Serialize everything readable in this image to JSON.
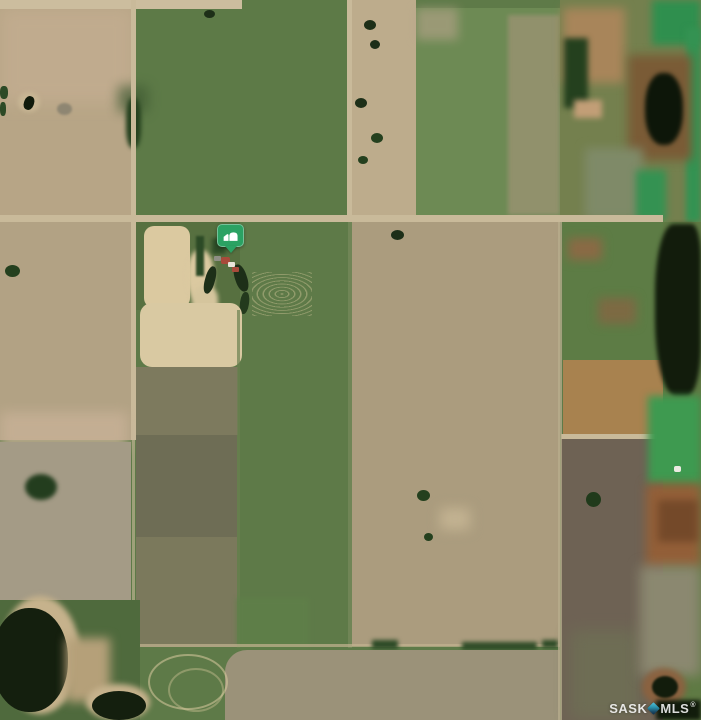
{
  "view": {
    "type": "satellite-aerial-map",
    "width_px": 701,
    "height_px": 720
  },
  "marker": {
    "label": "property-location",
    "x": 217,
    "y": 224,
    "badge_color": "#2BA263",
    "glyph": "farm-barn-icon",
    "glyph_color": "#FFFFFF"
  },
  "watermark": {
    "prefix": "SASK",
    "suffix": "MLS",
    "registered": "®",
    "text_color": "rgba(255,255,255,0.85)",
    "diamond_color_top": "#54C4DC",
    "diamond_color_bottom": "#0F2B46"
  },
  "palette": {
    "cropland_tan": "#B2A284",
    "pasture_green": "#5E7A48",
    "stubble_gray": "#A49B86",
    "seeded_green_rows": "#6D8A54",
    "olive_pasture": "#7B795C",
    "dark_brown_field": "#6E6254",
    "orange_field": "#A8824F",
    "wetland_emerald": "#3E9A50",
    "pond_dark": "#121C0C",
    "road_tan": "#C9BA9A",
    "farmyard_tan": "#DBC9A0",
    "rust_marsh": "#935F38"
  },
  "map": {
    "regions": [
      {
        "name": "pasture-base",
        "x": 0,
        "y": 0,
        "w": 701,
        "h": 720,
        "color": "#5e7a48",
        "cls": "mottle"
      },
      {
        "name": "field-topleft-tan",
        "x": 0,
        "y": 0,
        "w": 133,
        "h": 222,
        "color": "#b7a586",
        "cls": "rows-h"
      },
      {
        "name": "field-topleft-pink-wash",
        "x": 0,
        "y": 8,
        "w": 133,
        "h": 95,
        "color": "#c9b195",
        "blur": 8,
        "op": 0.55
      },
      {
        "name": "field-topmid-green",
        "x": 136,
        "y": 0,
        "w": 211,
        "h": 218,
        "color": "#5d7a47",
        "cls": "mottle"
      },
      {
        "name": "field-topright-tan-strip",
        "x": 352,
        "y": 0,
        "w": 64,
        "h": 218,
        "color": "#bdac8c",
        "cls": "rows-h"
      },
      {
        "name": "field-topright-green-striped",
        "x": 416,
        "y": 8,
        "w": 144,
        "h": 210,
        "color": "#6d8a54",
        "cls": "rows-v"
      },
      {
        "name": "field-striped-tan-east-half",
        "x": 508,
        "y": 15,
        "w": 52,
        "h": 200,
        "color": "#9a9372",
        "cls": "rows-v",
        "op": 0.8,
        "blur": 2
      },
      {
        "name": "field-striped-pink-corner",
        "x": 416,
        "y": 8,
        "w": 42,
        "h": 32,
        "color": "#b9a48c",
        "blur": 5,
        "op": 0.6
      },
      {
        "name": "road-top-strip",
        "x": 0,
        "y": 0,
        "w": 242,
        "h": 9,
        "color": "#ccbd9e"
      },
      {
        "name": "wetland-topright-base",
        "x": 560,
        "y": 0,
        "w": 141,
        "h": 222,
        "color": "#74804e",
        "cls": "mottle"
      },
      {
        "name": "wetland-brown-patch",
        "x": 563,
        "y": 8,
        "w": 62,
        "h": 75,
        "color": "#a8855a",
        "blur": 5
      },
      {
        "name": "wetland-dark-trees",
        "x": 564,
        "y": 38,
        "w": 24,
        "h": 70,
        "color": "#24401e",
        "blur": 3
      },
      {
        "name": "wetland-emerald-top",
        "x": 652,
        "y": 0,
        "w": 49,
        "h": 45,
        "color": "#2f8f4e",
        "blur": 4
      },
      {
        "name": "wetland-emerald-right-band",
        "x": 686,
        "y": 28,
        "w": 15,
        "h": 194,
        "color": "#349252",
        "blur": 3
      },
      {
        "name": "wetland-pond-surround",
        "x": 628,
        "y": 55,
        "w": 64,
        "h": 105,
        "color": "#7a5b36",
        "blur": 5
      },
      {
        "name": "wetland-pond-dark",
        "x": 645,
        "y": 73,
        "w": 38,
        "h": 72,
        "color": "#0d1609",
        "r": "45%",
        "blur": 2
      },
      {
        "name": "wetland-marsh-gray",
        "x": 585,
        "y": 148,
        "w": 58,
        "h": 72,
        "color": "#7f8a68",
        "blur": 5
      },
      {
        "name": "wetland-emerald-low",
        "x": 636,
        "y": 170,
        "w": 30,
        "h": 50,
        "color": "#349252",
        "blur": 4
      },
      {
        "name": "wetland-pink-spot",
        "x": 574,
        "y": 100,
        "w": 28,
        "h": 18,
        "color": "#c29e77",
        "blur": 3
      },
      {
        "name": "pond-dot-topmid",
        "x": 204,
        "y": 10,
        "w": 11,
        "h": 8,
        "color": "#1d2f18",
        "r": "50%"
      },
      {
        "name": "dark-smudge-topmid",
        "x": 118,
        "y": 86,
        "w": 30,
        "h": 26,
        "color": "#3f5a33",
        "blur": 6,
        "op": 0.7
      },
      {
        "name": "tree-clump-road-west",
        "x": 126,
        "y": 98,
        "w": 15,
        "h": 50,
        "color": "#24401e",
        "blur": 2,
        "r": "40%"
      },
      {
        "name": "slough-topleft-ring",
        "x": 18,
        "y": 92,
        "w": 22,
        "h": 20,
        "color": "#c8b694",
        "r": "50%",
        "blur": 2
      },
      {
        "name": "slough-topleft-dark",
        "x": 24,
        "y": 96,
        "w": 10,
        "h": 14,
        "color": "#101a0b",
        "r": "45%",
        "rot": 20
      },
      {
        "name": "green-dot-left-edge-1",
        "x": 0,
        "y": 86,
        "w": 8,
        "h": 13,
        "color": "#2c4a26",
        "r": "40%"
      },
      {
        "name": "green-dot-left-edge-2",
        "x": 0,
        "y": 102,
        "w": 6,
        "h": 14,
        "color": "#2c4a26",
        "r": "40%"
      },
      {
        "name": "gray-blob-topleft",
        "x": 57,
        "y": 103,
        "w": 15,
        "h": 12,
        "color": "#8e8672",
        "r": "50%",
        "blur": 1
      },
      {
        "name": "tree-dot-strip-1",
        "x": 364,
        "y": 20,
        "w": 12,
        "h": 10,
        "color": "#1d2f18",
        "r": "50%"
      },
      {
        "name": "tree-dot-strip-2",
        "x": 370,
        "y": 40,
        "w": 10,
        "h": 9,
        "color": "#1d2f18",
        "r": "50%"
      },
      {
        "name": "tree-dot-strip-3",
        "x": 355,
        "y": 98,
        "w": 12,
        "h": 10,
        "color": "#1d2f18",
        "r": "50%"
      },
      {
        "name": "tree-dot-strip-4",
        "x": 371,
        "y": 133,
        "w": 12,
        "h": 10,
        "color": "#24401e",
        "r": "50%"
      },
      {
        "name": "tree-dot-strip-5",
        "x": 358,
        "y": 156,
        "w": 10,
        "h": 8,
        "color": "#24401e",
        "r": "50%"
      },
      {
        "name": "road-horizontal",
        "x": 0,
        "y": 215,
        "w": 663,
        "h": 7,
        "color": "#c9ba9a"
      },
      {
        "name": "road-vertical-west",
        "x": 131,
        "y": 0,
        "w": 5,
        "h": 440,
        "color": "#c9ba9a"
      },
      {
        "name": "road-vertical-mid",
        "x": 347,
        "y": 0,
        "w": 5,
        "h": 221,
        "color": "#c9ba9a"
      },
      {
        "name": "field-left-tan-lower",
        "x": 0,
        "y": 222,
        "w": 131,
        "h": 218,
        "color": "#b2a284",
        "cls": "rows-h"
      },
      {
        "name": "trees-left-lower",
        "x": 5,
        "y": 265,
        "w": 15,
        "h": 12,
        "color": "#24401e",
        "r": "50%"
      },
      {
        "name": "field-left-pink-band",
        "x": 0,
        "y": 412,
        "w": 128,
        "h": 38,
        "color": "#c8b197",
        "blur": 6,
        "op": 0.8
      },
      {
        "name": "field-left-gray",
        "x": 0,
        "y": 442,
        "w": 131,
        "h": 188,
        "color": "#a49b86",
        "cls": "mottle"
      },
      {
        "name": "tree-gray-shadow",
        "x": 25,
        "y": 474,
        "w": 32,
        "h": 26,
        "color": "#233d1e",
        "r": "50%",
        "blur": 2
      },
      {
        "name": "boundary-vertical-west-lower",
        "x": 132,
        "y": 440,
        "w": 3,
        "h": 210,
        "color": "#cabb9b",
        "op": 0.6
      },
      {
        "name": "yard-green-backdrop",
        "x": 136,
        "y": 222,
        "w": 104,
        "h": 88,
        "color": "#566f3f",
        "op": 0.85
      },
      {
        "name": "yard-scribble-patch",
        "x": 144,
        "y": 226,
        "w": 46,
        "h": 82,
        "color": "#dbc9a0",
        "cls": "scribble",
        "r": "10px"
      },
      {
        "name": "yard-tan-blob-1",
        "x": 187,
        "y": 250,
        "w": 27,
        "h": 52,
        "color": "#dbc9a0",
        "r": "45%",
        "blur": 2
      },
      {
        "name": "yard-tan-blob-2",
        "x": 192,
        "y": 286,
        "w": 26,
        "h": 32,
        "color": "#d5c59d",
        "r": "40%",
        "blur": 2
      },
      {
        "name": "yard-shelterbelt",
        "x": 196,
        "y": 236,
        "w": 8,
        "h": 40,
        "color": "#2c4a26",
        "blur": 1
      },
      {
        "name": "yard-trees-2",
        "x": 212,
        "y": 238,
        "w": 14,
        "h": 16,
        "color": "#2c4a26",
        "blur": 2
      },
      {
        "name": "yard-dugout-1",
        "x": 205,
        "y": 266,
        "w": 10,
        "h": 28,
        "color": "#1d2f18",
        "r": "45%",
        "rot": 15
      },
      {
        "name": "yard-dugout-2",
        "x": 235,
        "y": 264,
        "w": 12,
        "h": 28,
        "color": "#1d2f18",
        "r": "45%",
        "rot": -18
      },
      {
        "name": "yard-dugout-3",
        "x": 240,
        "y": 292,
        "w": 9,
        "h": 22,
        "color": "#233a1d",
        "r": "45%",
        "rot": 8
      },
      {
        "name": "yard-building-gray",
        "x": 214,
        "y": 256,
        "w": 7,
        "h": 5,
        "color": "#8e8e84",
        "r": "1px"
      },
      {
        "name": "yard-building-red-1",
        "x": 221,
        "y": 257,
        "w": 9,
        "h": 7,
        "color": "#a84a3a",
        "r": "2px"
      },
      {
        "name": "yard-building-white",
        "x": 228,
        "y": 262,
        "w": 7,
        "h": 5,
        "color": "#e9e5da",
        "r": "1px"
      },
      {
        "name": "yard-building-red-2",
        "x": 232,
        "y": 267,
        "w": 7,
        "h": 5,
        "color": "#a84a3a",
        "r": "1px"
      },
      {
        "name": "yard-scratches-east",
        "x": 252,
        "y": 272,
        "w": 60,
        "h": 44,
        "cls": "scribble-faint"
      },
      {
        "name": "bale-yard-tan-patch",
        "x": 140,
        "y": 303,
        "w": 102,
        "h": 64,
        "color": "#d9c9a2",
        "cls": "scribble",
        "r": "12px"
      },
      {
        "name": "pasture-mid-brown-upper",
        "x": 136,
        "y": 367,
        "w": 102,
        "h": 68,
        "color": "#7d7a5e",
        "cls": "scribble-faint2"
      },
      {
        "name": "pasture-mid-dark",
        "x": 136,
        "y": 435,
        "w": 101,
        "h": 102,
        "color": "#6e6d55",
        "cls": "mottle"
      },
      {
        "name": "pasture-mid-olive",
        "x": 136,
        "y": 537,
        "w": 101,
        "h": 110,
        "color": "#7b795c",
        "cls": "mottle"
      },
      {
        "name": "boundary-east-of-olive",
        "x": 237,
        "y": 310,
        "w": 3,
        "h": 338,
        "color": "#6a8050",
        "op": 0.7
      },
      {
        "name": "green-strip-bright",
        "x": 237,
        "y": 598,
        "w": 72,
        "h": 50,
        "color": "#5f7f49",
        "blur": 3,
        "op": 0.9
      },
      {
        "name": "field-big-diagonal",
        "x": 352,
        "y": 222,
        "w": 208,
        "h": 424,
        "color": "#ab9c7e",
        "cls": "rows-d"
      },
      {
        "name": "boundary-vertical-mid-lower",
        "x": 348,
        "y": 222,
        "w": 4,
        "h": 426,
        "color": "#74885a",
        "op": 0.8
      },
      {
        "name": "field-diag-tree-1",
        "x": 391,
        "y": 230,
        "w": 13,
        "h": 10,
        "color": "#1d2f18",
        "r": "50%"
      },
      {
        "name": "field-diag-tree-2",
        "x": 417,
        "y": 490,
        "w": 13,
        "h": 11,
        "color": "#24401e",
        "r": "50%"
      },
      {
        "name": "field-diag-tree-3",
        "x": 424,
        "y": 533,
        "w": 9,
        "h": 8,
        "color": "#24401e",
        "r": "50%"
      },
      {
        "name": "field-diag-light-blob",
        "x": 440,
        "y": 508,
        "w": 30,
        "h": 22,
        "color": "#c2b291",
        "blur": 6
      },
      {
        "name": "boundary-bottom-fields",
        "x": 136,
        "y": 644,
        "w": 424,
        "h": 3,
        "color": "#c3b492",
        "op": 0.7
      },
      {
        "name": "bush-line-1",
        "x": 372,
        "y": 640,
        "w": 26,
        "h": 9,
        "color": "#2c4a26",
        "blur": 2
      },
      {
        "name": "bush-line-2",
        "x": 462,
        "y": 642,
        "w": 75,
        "h": 8,
        "color": "#2c4a26",
        "blur": 2
      },
      {
        "name": "bush-line-3",
        "x": 542,
        "y": 640,
        "w": 16,
        "h": 8,
        "color": "#2c4a26",
        "blur": 2
      },
      {
        "name": "field-bottom-gray",
        "x": 225,
        "y": 650,
        "w": 335,
        "h": 70,
        "color": "#9b9279",
        "cls": "mottle",
        "r": "22px 0 0 0"
      },
      {
        "name": "trail-loop-1",
        "x": 148,
        "y": 654,
        "w": 76,
        "h": 52,
        "cls": "loop",
        "r": "50%"
      },
      {
        "name": "trail-loop-2",
        "x": 168,
        "y": 668,
        "w": 52,
        "h": 40,
        "cls": "loop",
        "r": "50%",
        "op": 0.7
      },
      {
        "name": "wetland-east-green-hummock",
        "x": 563,
        "y": 222,
        "w": 100,
        "h": 138,
        "color": "#5d7c45",
        "cls": "mottle"
      },
      {
        "name": "hummock-brown-1",
        "x": 568,
        "y": 238,
        "w": 34,
        "h": 22,
        "color": "#8a6a45",
        "blur": 5
      },
      {
        "name": "hummock-brown-2",
        "x": 598,
        "y": 298,
        "w": 38,
        "h": 26,
        "color": "#7d6a43",
        "blur": 5
      },
      {
        "name": "field-orange",
        "x": 563,
        "y": 360,
        "w": 100,
        "h": 76,
        "color": "#a8824f",
        "cls": "mottle"
      },
      {
        "name": "road-orange-south",
        "x": 561,
        "y": 434,
        "w": 104,
        "h": 5,
        "color": "#c9ba9a"
      },
      {
        "name": "field-dark-brown",
        "x": 561,
        "y": 439,
        "w": 108,
        "h": 281,
        "color": "#6e6254",
        "cls": "rows-v-faint"
      },
      {
        "name": "field-dark-brown-green-tinge",
        "x": 570,
        "y": 630,
        "w": 70,
        "h": 90,
        "color": "#6e7055",
        "blur": 8,
        "op": 0.8
      },
      {
        "name": "dark-knob",
        "x": 586,
        "y": 492,
        "w": 15,
        "h": 15,
        "color": "#203a1b",
        "r": "50%"
      },
      {
        "name": "boundary-vertical-east",
        "x": 558,
        "y": 222,
        "w": 4,
        "h": 498,
        "color": "#b8ad8d",
        "op": 0.75
      },
      {
        "name": "wetland-east-base",
        "x": 663,
        "y": 222,
        "w": 38,
        "h": 498,
        "color": "#5f7a44",
        "cls": "mottle"
      },
      {
        "name": "pond-east-large",
        "x": 655,
        "y": 224,
        "w": 46,
        "h": 172,
        "color": "#121c0c",
        "r": "40% 20% 30% 45%",
        "blur": 2
      },
      {
        "name": "emerald-east-band",
        "x": 648,
        "y": 396,
        "w": 53,
        "h": 88,
        "color": "#3e9a50",
        "blur": 4
      },
      {
        "name": "white-dot-building",
        "x": 674,
        "y": 466,
        "w": 7,
        "h": 6,
        "color": "#eceae2",
        "r": "2px"
      },
      {
        "name": "rust-patch-east",
        "x": 646,
        "y": 484,
        "w": 55,
        "h": 84,
        "color": "#935f38",
        "blur": 5
      },
      {
        "name": "rust-dark-flecks",
        "x": 658,
        "y": 500,
        "w": 40,
        "h": 42,
        "color": "#6d4426",
        "blur": 4,
        "op": 0.8
      },
      {
        "name": "marsh-gray-east",
        "x": 640,
        "y": 566,
        "w": 61,
        "h": 110,
        "color": "#8b8870",
        "blur": 6
      },
      {
        "name": "pond-ring-east",
        "x": 642,
        "y": 668,
        "w": 44,
        "h": 38,
        "color": "#8a6240",
        "r": "50%",
        "blur": 3
      },
      {
        "name": "pond-east-small",
        "x": 652,
        "y": 676,
        "w": 26,
        "h": 22,
        "color": "#121c0c",
        "r": "50%",
        "blur": 1
      },
      {
        "name": "pond-corner-se",
        "x": 656,
        "y": 700,
        "w": 45,
        "h": 20,
        "color": "#121c0c",
        "blur": 2
      },
      {
        "name": "marsh-bottomleft-base",
        "x": 0,
        "y": 600,
        "w": 140,
        "h": 120,
        "color": "#4f6a3d",
        "cls": "mottle"
      },
      {
        "name": "sand-shore-1",
        "x": 0,
        "y": 596,
        "w": 80,
        "h": 118,
        "color": "#c6b28c",
        "r": "50%",
        "blur": 3
      },
      {
        "name": "pond-west-large",
        "x": -8,
        "y": 608,
        "w": 76,
        "h": 104,
        "color": "#141f0e",
        "r": "48%"
      },
      {
        "name": "sand-patch-mid",
        "x": 66,
        "y": 638,
        "w": 44,
        "h": 64,
        "color": "#b5a079",
        "blur": 5,
        "cls": "scribble-faint"
      },
      {
        "name": "sand-shore-2",
        "x": 86,
        "y": 684,
        "w": 64,
        "h": 36,
        "color": "#c6b28c",
        "r": "50%",
        "blur": 3
      },
      {
        "name": "pond-west-small",
        "x": 92,
        "y": 691,
        "w": 54,
        "h": 29,
        "color": "#141f0e",
        "r": "50%"
      }
    ]
  }
}
